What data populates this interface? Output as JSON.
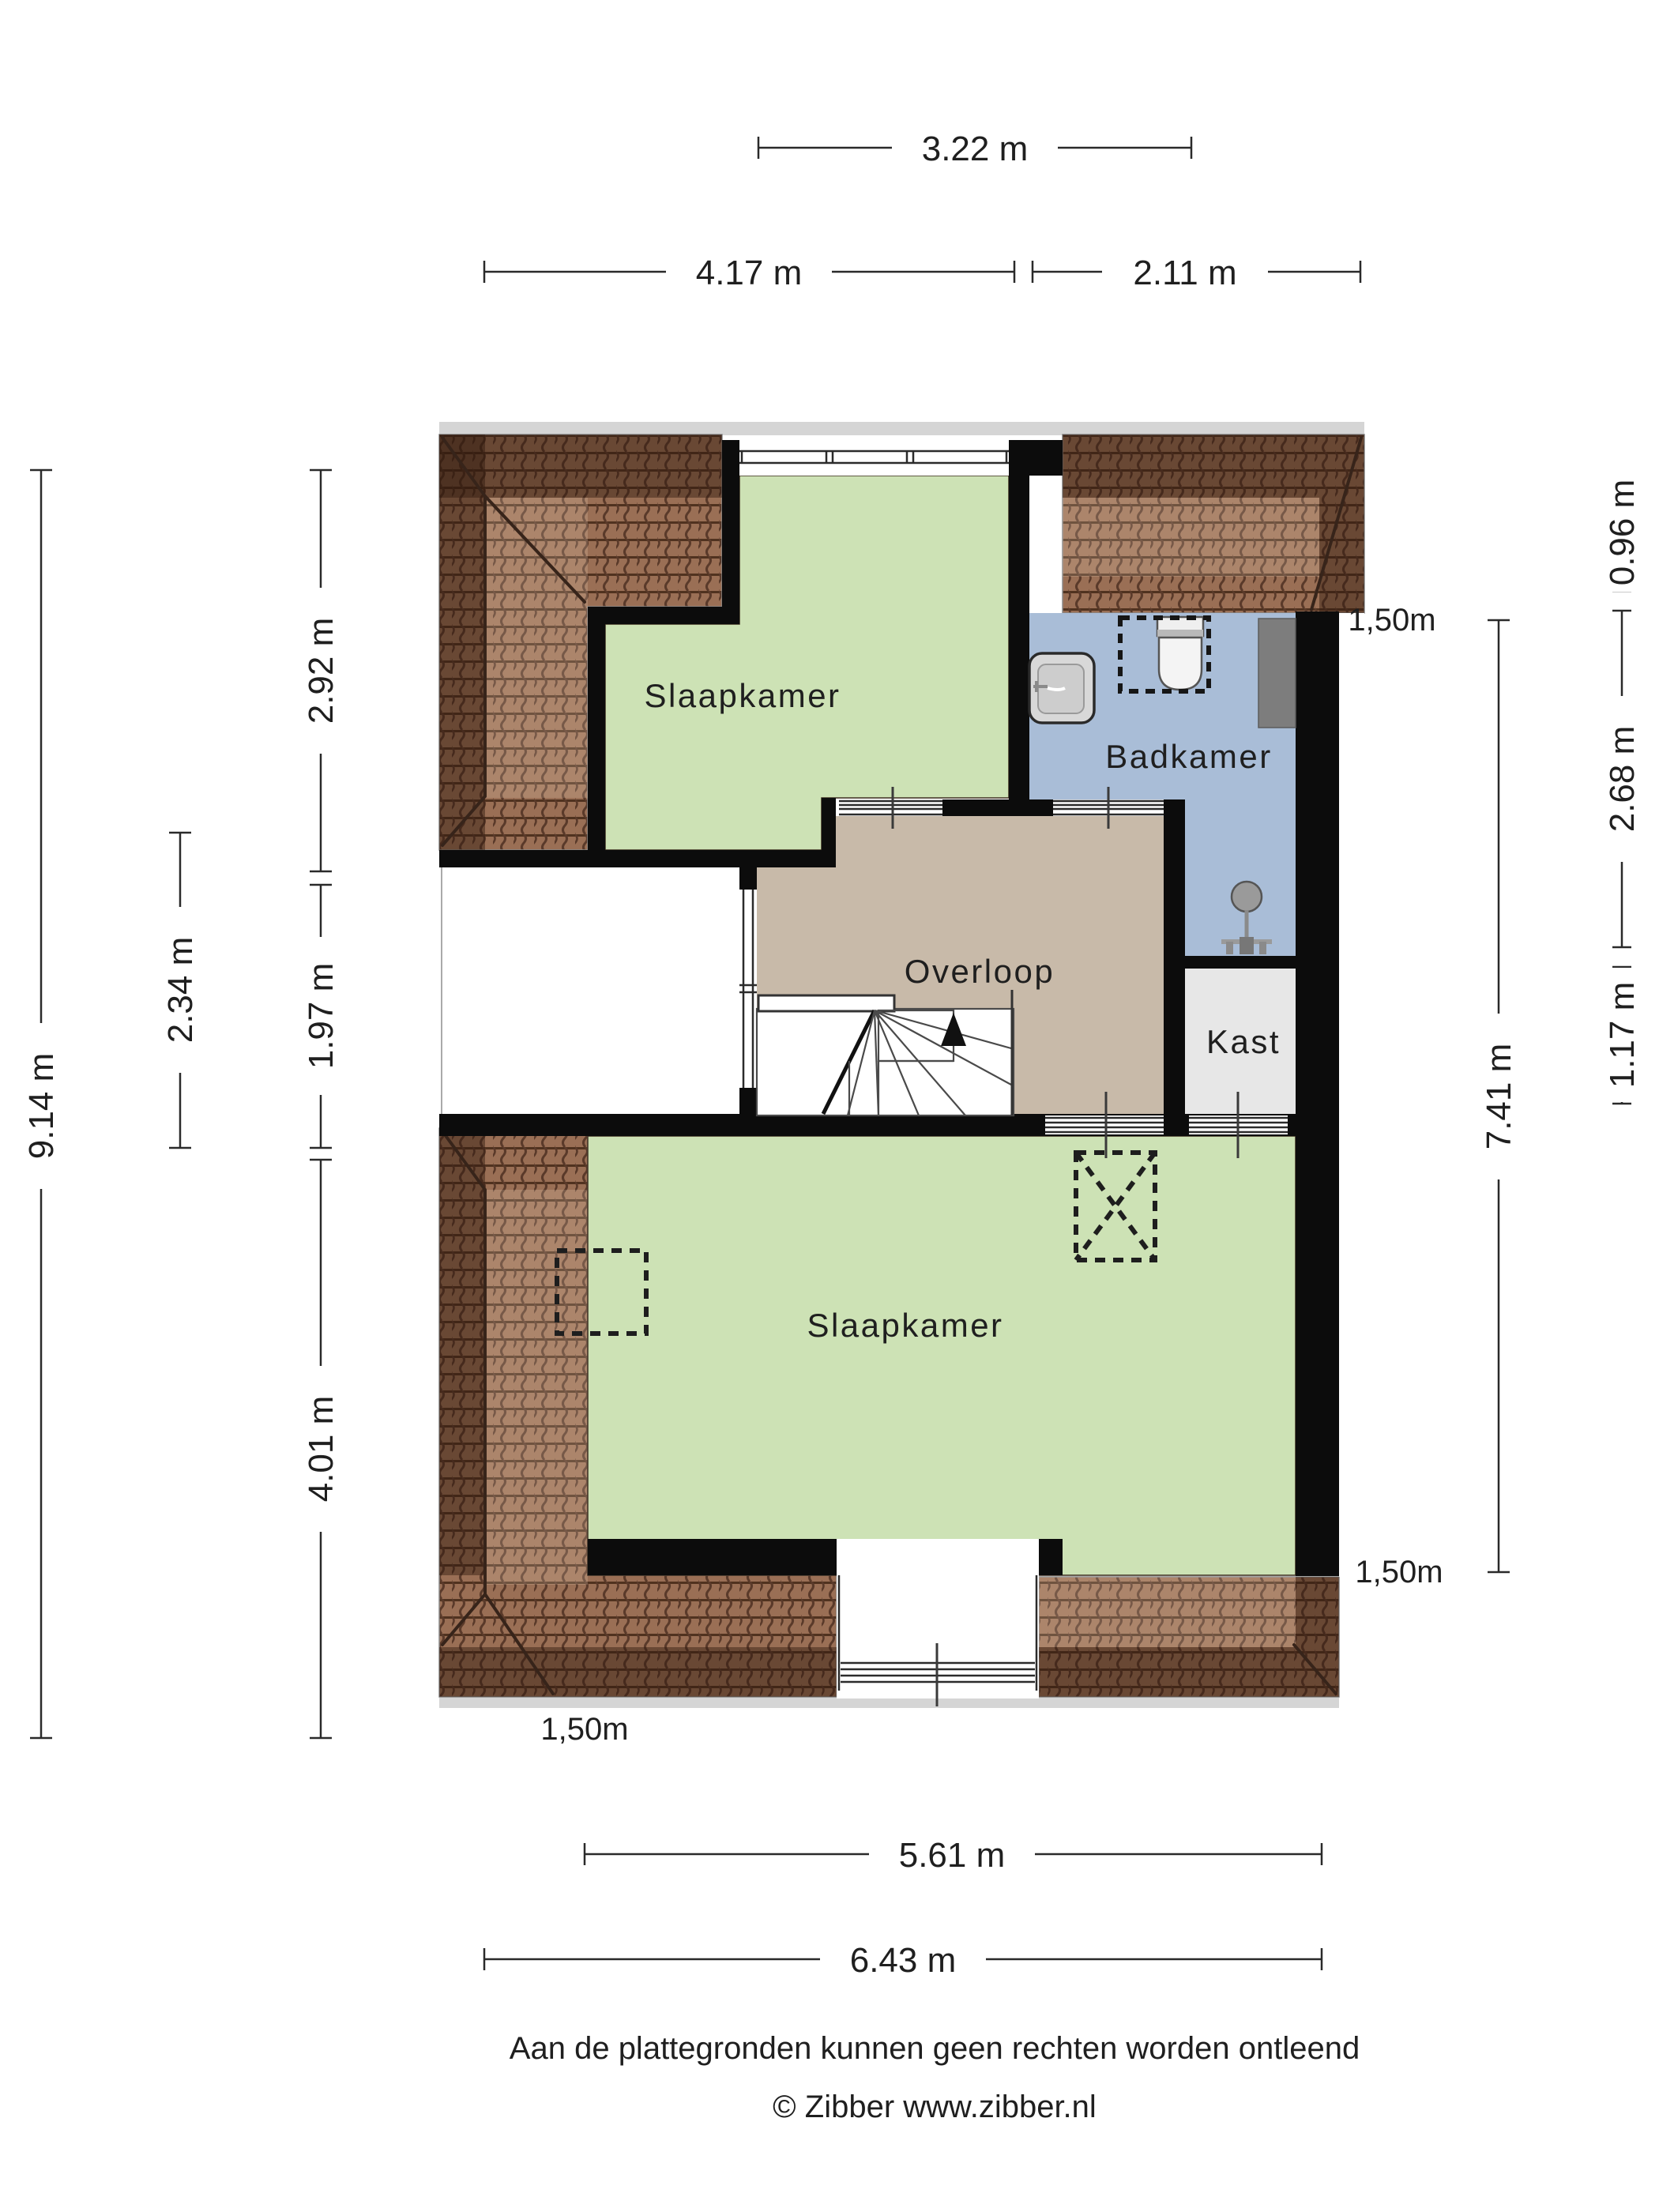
{
  "plan": {
    "rooms": [
      {
        "id": "slaapkamer-1",
        "label": "Slaapkamer"
      },
      {
        "id": "badkamer",
        "label": "Badkamer"
      },
      {
        "id": "overloop",
        "label": "Overloop"
      },
      {
        "id": "kast",
        "label": "Kast"
      },
      {
        "id": "slaapkamer-2",
        "label": "Slaapkamer"
      }
    ],
    "colors": {
      "room_green": "#cde2b5",
      "room_tan": "#c8baa9",
      "room_blue": "#a9bdd7",
      "room_gray": "#e7e7e7",
      "wall_black": "#0c0c0c",
      "roof_base": "#9a6f55",
      "roof_line": "#50321f",
      "duct_gray": "#7d7d7d"
    }
  },
  "dims": {
    "top": [
      {
        "label": "3.22 m"
      },
      {
        "label": "4.17 m"
      },
      {
        "label": "2.11 m"
      }
    ],
    "bottom": [
      {
        "label": "5.61 m"
      },
      {
        "label": "6.43 m"
      }
    ],
    "left": [
      {
        "label": "9.14 m"
      },
      {
        "label": "2.34 m"
      },
      {
        "label": "2.92 m"
      },
      {
        "label": "1.97 m"
      },
      {
        "label": "4.01 m"
      }
    ],
    "right": [
      {
        "label": "7.41 m"
      },
      {
        "label": "0.96 m"
      },
      {
        "label": "2.68 m"
      },
      {
        "label": "1.17 m"
      }
    ],
    "free": [
      {
        "label": "1,50m"
      },
      {
        "label": "1,50m"
      },
      {
        "label": "1,50m"
      }
    ]
  },
  "footer": {
    "line1": "Aan de plattegronden kunnen geen rechten worden ontleend",
    "line2": "© Zibber www.zibber.nl"
  }
}
